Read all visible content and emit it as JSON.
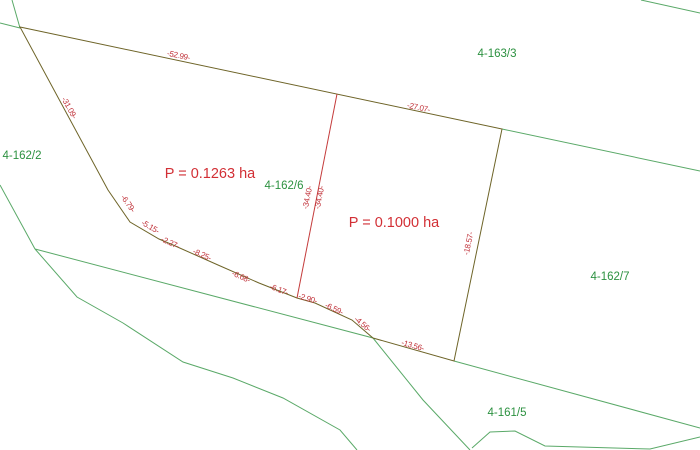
{
  "colors": {
    "background": "#ffffff",
    "subject_boundary": "#6e6428",
    "divider_line": "#c43b3b",
    "dimension_text": "#c03038",
    "parcel_text": "#2c9140",
    "neighbor_line": "#5aa968",
    "area_text": "#d22f35"
  },
  "parcel_labels": [
    {
      "text": "4-163/3"
    },
    {
      "text": "4-162/2"
    },
    {
      "text": "4-162/6"
    },
    {
      "text": "4-162/7"
    },
    {
      "text": "4-161/5"
    }
  ],
  "area_labels": [
    {
      "text": "P = 0.1263 ha",
      "parcel": "4-162/6"
    },
    {
      "text": "P = 0.1000 ha",
      "parcel": "4-162/7"
    }
  ],
  "dimension_labels": [
    {
      "edge": "top-left-of-divider",
      "text": "-52.99-"
    },
    {
      "edge": "top-right-of-divider",
      "text": "-27.07-"
    },
    {
      "edge": "upper-left",
      "text": "-31.09-"
    },
    {
      "edge": "lower-left-1",
      "text": "-6.79-"
    },
    {
      "edge": "lower-left-2",
      "text": "-5.15-"
    },
    {
      "edge": "lower-left-3",
      "text": "-2.27-"
    },
    {
      "edge": "lower-left-4",
      "text": "-8.25-"
    },
    {
      "edge": "bottom-1",
      "text": "-6.68-"
    },
    {
      "edge": "bottom-2",
      "text": "-6.17-"
    },
    {
      "edge": "bottom-3",
      "text": "-2.90-"
    },
    {
      "edge": "bottom-4",
      "text": "-6.59-"
    },
    {
      "edge": "bottom-5",
      "text": "-4.56-"
    },
    {
      "edge": "bottom-6",
      "text": "-13.56-"
    },
    {
      "edge": "right",
      "text": "-18.57-"
    },
    {
      "edge": "divider-west-side",
      "text": "-34.40-"
    },
    {
      "edge": "divider-east-side",
      "text": "-34.40-"
    }
  ]
}
